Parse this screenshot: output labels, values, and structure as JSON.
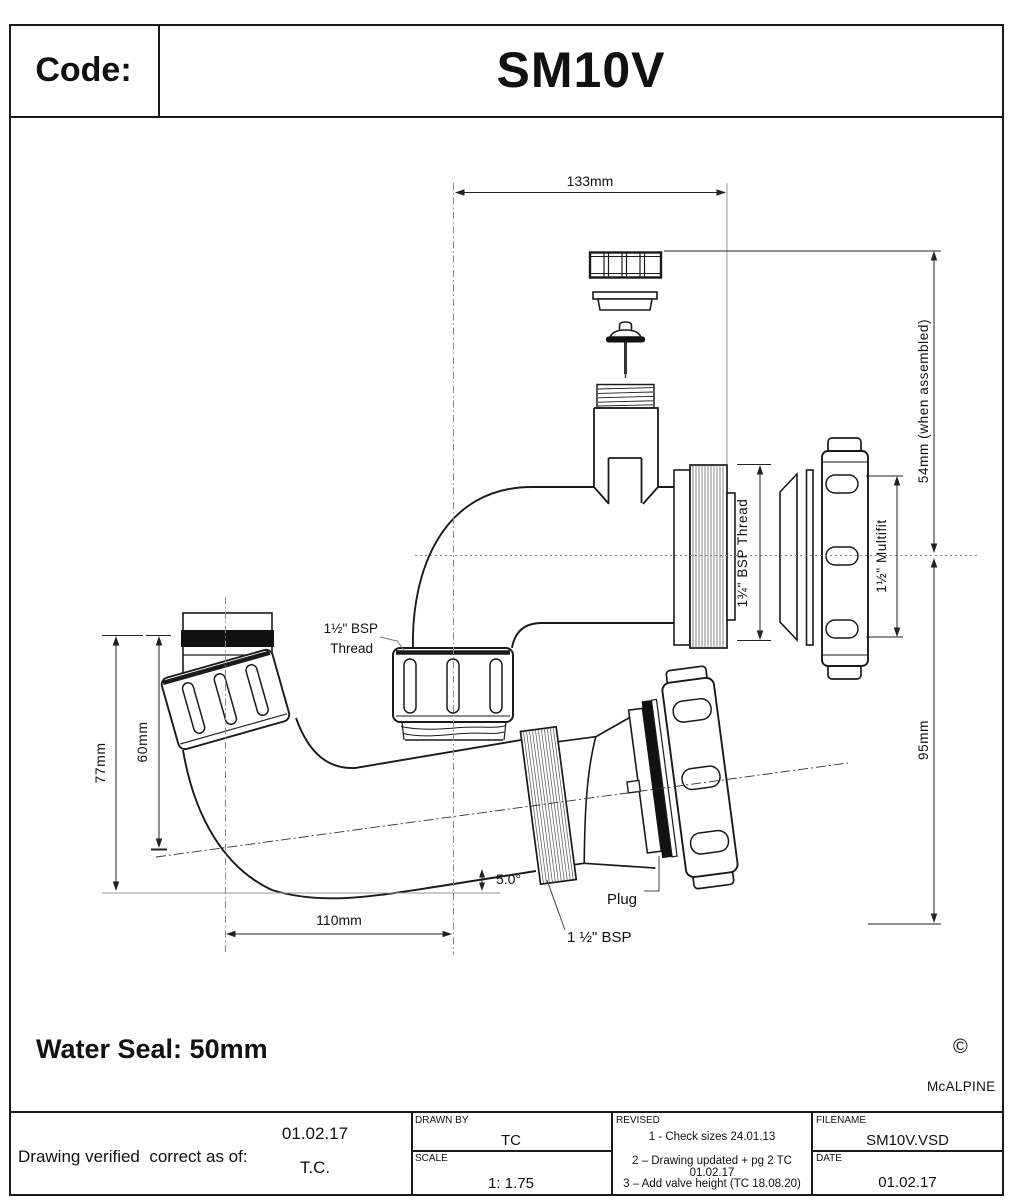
{
  "title_block": {
    "code_label": "Code:",
    "code_value": "SM10V"
  },
  "drawing": {
    "dim_width_top": "133mm",
    "dim_height_assembled": "54mm (when assembled)",
    "dim_height_lower": "95mm",
    "label_multifit": "1½\" Multifit",
    "label_bsp_134": "1¾\" BSP Thread",
    "label_bsp_112_line1": "1½\" BSP",
    "label_bsp_112_line2": "Thread",
    "dim_height_77": "77mm",
    "dim_height_60": "60mm",
    "dim_width_110": "110mm",
    "angle": "5.0°",
    "label_plug": "Plug",
    "label_bsp_tail": "1 ½\" BSP",
    "water_seal": "Water Seal: 50mm",
    "copyright_symbol": "©",
    "brand": "McALPINE"
  },
  "footer": {
    "verified_label": "Drawing verified  correct as of:",
    "verified_date": "01.02.17",
    "verified_initials": "T.C.",
    "drawn_by_label": "DRAWN BY",
    "drawn_by_value": "TC",
    "scale_label": "SCALE",
    "scale_value": "1: 1.75",
    "revised_label": "REVISED",
    "revisions": [
      "1 - Check sizes 24.01.13",
      "2 – Drawing updated + pg 2 TC 01.02.17",
      "3 – Add valve height (TC 18.08.20)"
    ],
    "filename_label": "FILENAME",
    "filename_value": "SM10V.VSD",
    "date_label": "DATE",
    "date_value": "01.02.17"
  }
}
